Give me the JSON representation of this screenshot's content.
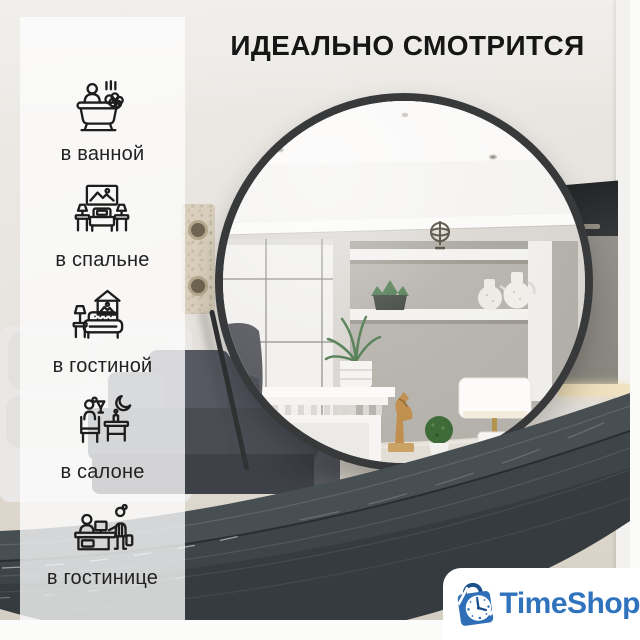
{
  "title": "ИДЕАЛЬНО СМОТРИТСЯ",
  "sidebar": {
    "items": [
      {
        "icon": "bathtub-icon",
        "label": "в ванной"
      },
      {
        "icon": "bedroom-icon",
        "label": "в спальне"
      },
      {
        "icon": "livingroom-icon",
        "label": "в гостиной"
      },
      {
        "icon": "salon-icon",
        "label": "в салоне"
      },
      {
        "icon": "hotel-reception-icon",
        "label": "в гостинице"
      }
    ]
  },
  "brand": {
    "name": "TimeShop",
    "icon": "shopping-bag-clock-icon"
  },
  "colors": {
    "accent_blue": "#2f73bd",
    "logo_dark_blue": "#1d4f8c",
    "mirror_frame": "#37393b",
    "band_graphite": "#3f464a",
    "title_text": "#161616",
    "label_text": "#222222",
    "sidebar_overlay": "rgba(252,252,252,0.78)"
  }
}
